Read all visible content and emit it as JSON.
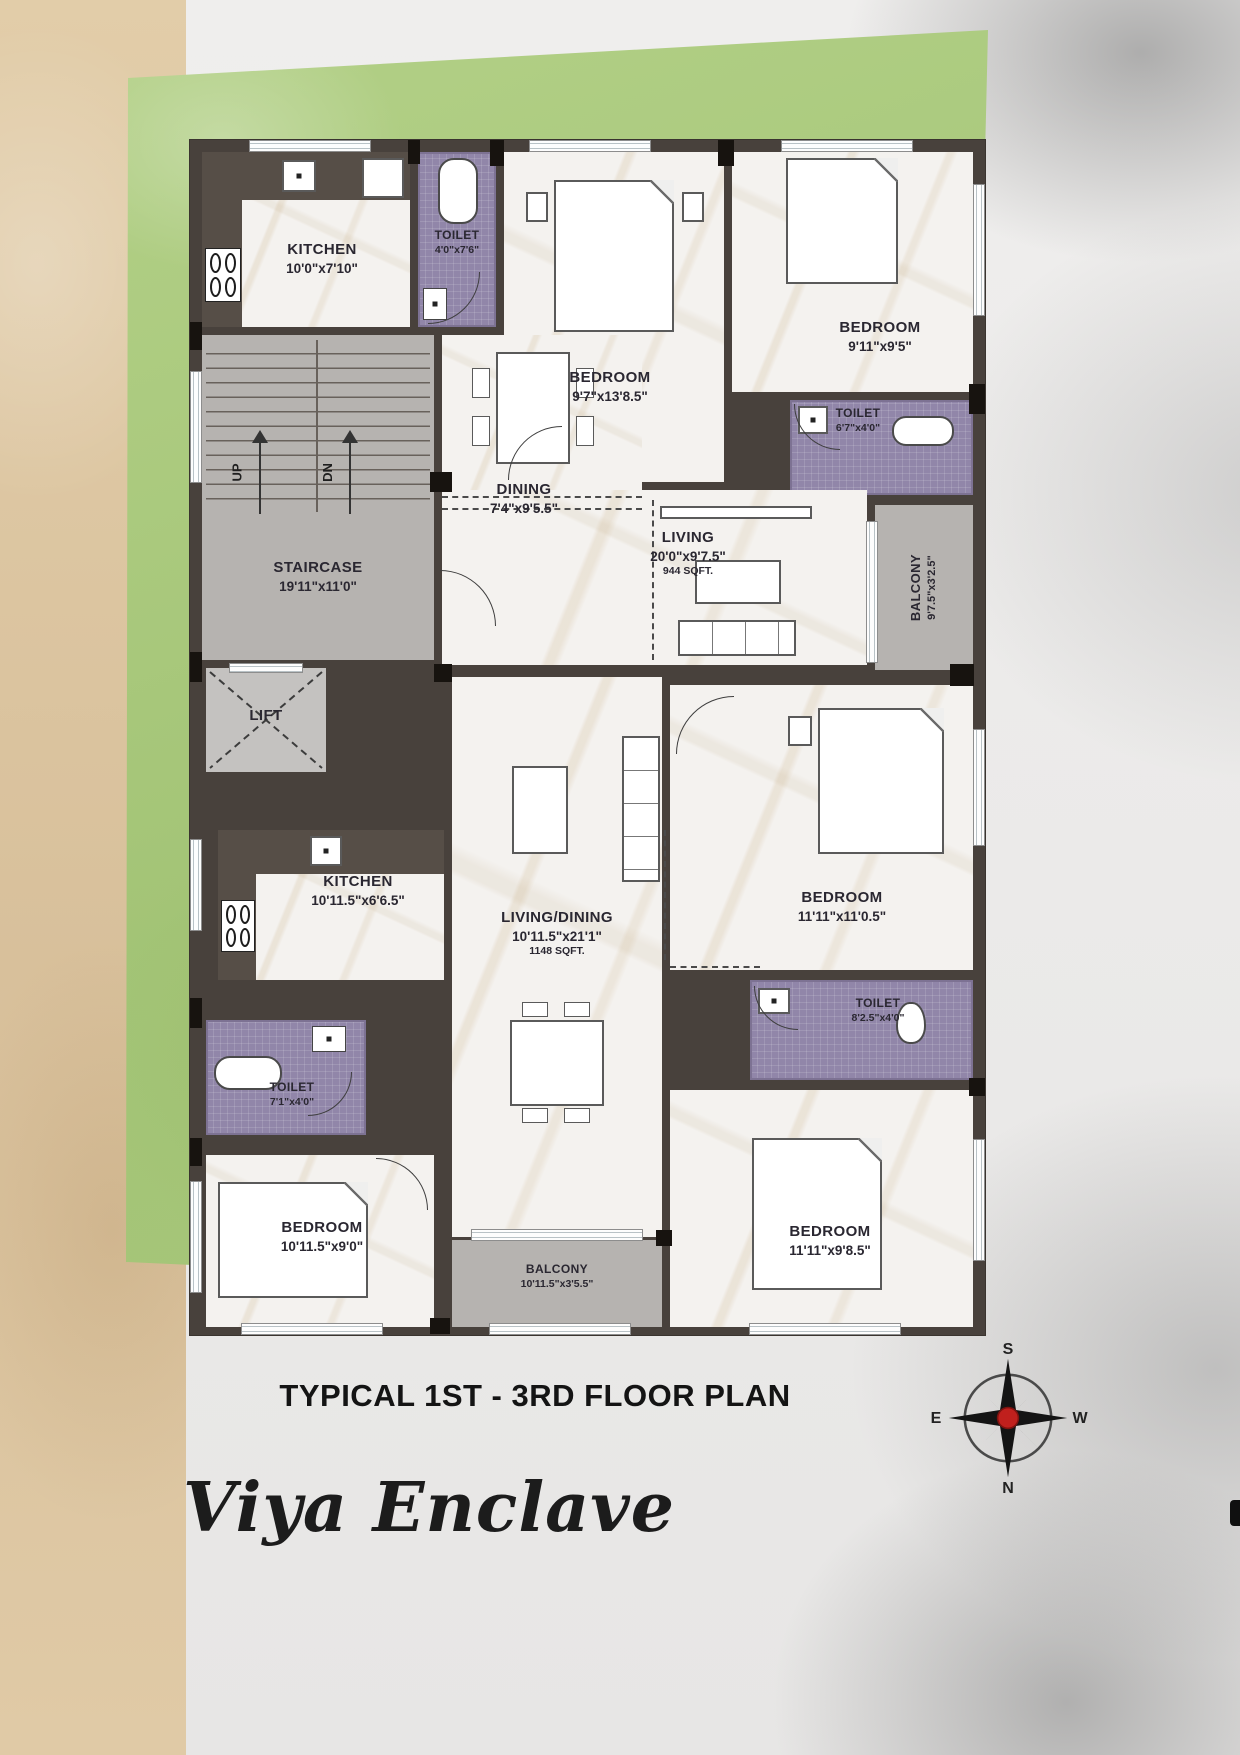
{
  "footer": {
    "caption": "TYPICAL 1ST - 3RD FLOOR PLAN",
    "project": "Viya Enclave"
  },
  "compass": {
    "top": "S",
    "right": "W",
    "bottom": "N",
    "left": "E"
  },
  "staircase_marks": {
    "up": "UP",
    "down": "DN"
  },
  "rooms": {
    "kitchen1": {
      "name": "KITCHEN",
      "dims": "10'0\"x7'10\""
    },
    "toilet1": {
      "name": "TOILET",
      "dims": "4'0\"x7'6\""
    },
    "bedroom1": {
      "name": "BEDROOM",
      "dims": "9'7\"x13'8.5\""
    },
    "bedroom2": {
      "name": "BEDROOM",
      "dims": "9'11\"x9'5\""
    },
    "toilet2": {
      "name": "TOILET",
      "dims": "6'7\"x4'0\""
    },
    "dining": {
      "name": "DINING",
      "dims": "7'4\"x9'5.5\""
    },
    "living": {
      "name": "LIVING",
      "dims": "20'0\"x9'7.5\"",
      "area": "944 SQFT."
    },
    "balcony1": {
      "name": "BALCONY",
      "dims": "9'7.5\"x3'2.5\""
    },
    "staircase": {
      "name": "STAIRCASE",
      "dims": "19'11\"x11'0\""
    },
    "lift": {
      "name": "LIFT"
    },
    "kitchen2": {
      "name": "KITCHEN",
      "dims": "10'11.5\"x6'6.5\""
    },
    "toilet3": {
      "name": "TOILET",
      "dims": "7'1\"x4'0\""
    },
    "livingdining": {
      "name": "LIVING/DINING",
      "dims": "10'11.5\"x21'1\"",
      "area": "1148 SQFT."
    },
    "bedroom3": {
      "name": "BEDROOM",
      "dims": "11'11\"x11'0.5\""
    },
    "toilet4": {
      "name": "TOILET",
      "dims": "8'2.5\"x4'0\""
    },
    "bedroom4": {
      "name": "BEDROOM",
      "dims": "10'11.5\"x9'0\""
    },
    "balcony2": {
      "name": "BALCONY",
      "dims": "10'11.5\"x3'5.5\""
    },
    "bedroom5": {
      "name": "BEDROOM",
      "dims": "11'11\"x9'8.5\""
    }
  },
  "colors": {
    "site_green": "#a6c677",
    "wall": "#48413c",
    "toilet_purple": "#9186a9",
    "balcony_gray": "#b6b3b0",
    "sand_strip": "#dcc6a4",
    "compass_red": "#c0201d"
  }
}
